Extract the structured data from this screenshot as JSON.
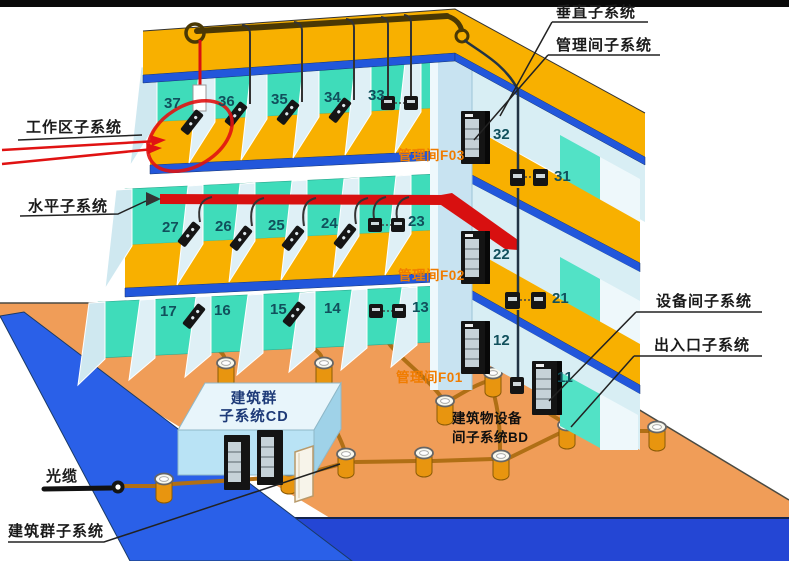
{
  "diagram_title": "综合布线系统结构示意图",
  "labels": {
    "vertical": "垂直子系统",
    "management": "管理间子系统",
    "work_area": "工作区子系统",
    "horizontal": "水平子系统",
    "equipment": "设备间子系统",
    "entrance": "出入口子系统",
    "optical": "光缆",
    "campus": "建筑群子系统",
    "cd1": "建筑群",
    "cd2": "子系统CD",
    "bd1": "建筑物设备",
    "bd2": "间子系统BD",
    "f03": "管理间F03",
    "f02": "管理间F02",
    "f01": "管理间F01"
  },
  "rooms": {
    "f3": [
      "37",
      "36",
      "35",
      "34",
      "33",
      "32",
      "31"
    ],
    "f2": [
      "27",
      "26",
      "25",
      "24",
      "23",
      "22",
      "21"
    ],
    "f1": [
      "17",
      "16",
      "15",
      "14",
      "13",
      "12",
      "11"
    ]
  },
  "colors": {
    "wall_teal": "#3fdcba",
    "slab_yellow": "#f8b000",
    "edge_blue": "#2257db",
    "ground_orange": "#f09d58",
    "road_blue": "#2a60e8",
    "water_blue": "#2446d4",
    "cable_red": "#d81010",
    "mgmt_text_orange": "#f07c00",
    "conduit_brown": "#b06f15"
  }
}
